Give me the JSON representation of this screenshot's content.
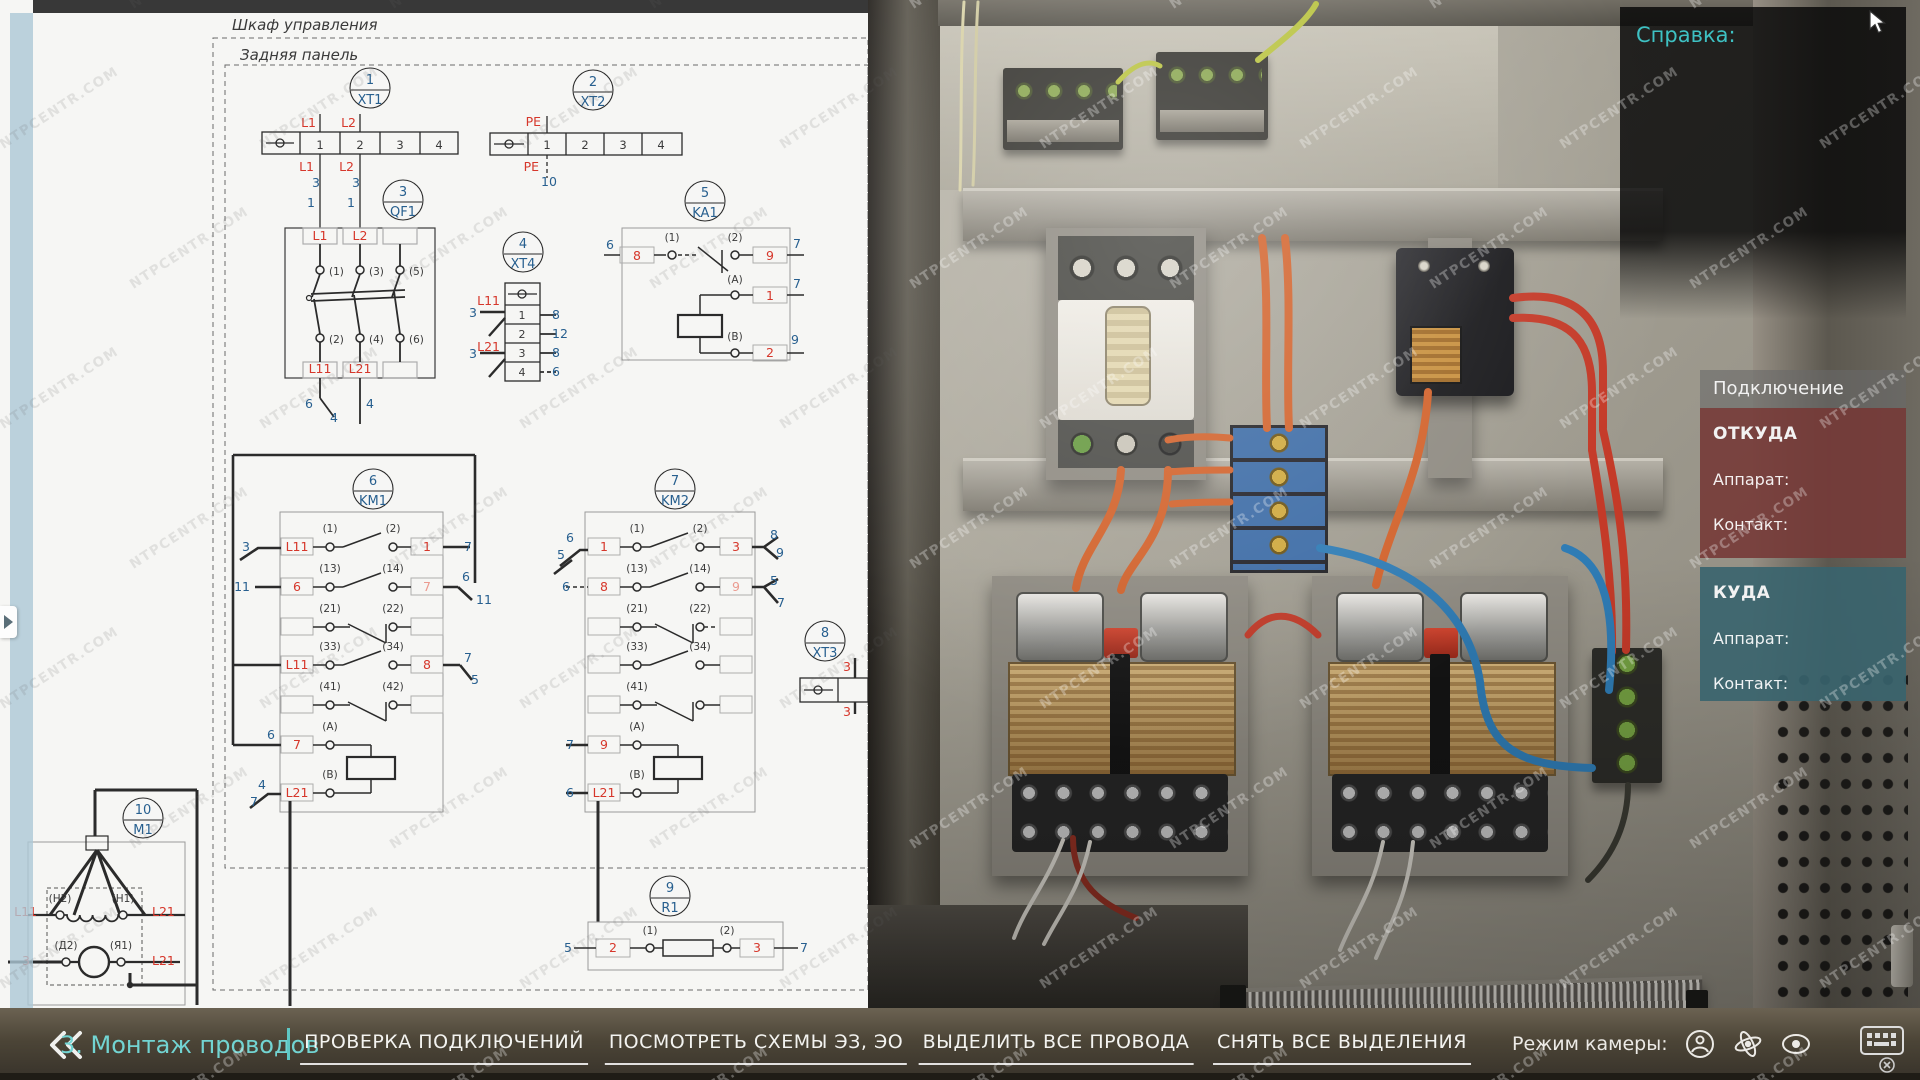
{
  "watermark": {
    "text": "NTPCENTR.COM"
  },
  "help_panel": {
    "title": "Справка:"
  },
  "connection_panel": {
    "title": "Подключение",
    "from": {
      "title": "ОТКУДА",
      "device_label": "Аппарат:",
      "contact_label": "Контакт:"
    },
    "to": {
      "title": "КУДА",
      "device_label": "Аппарат:",
      "contact_label": "Контакт:"
    }
  },
  "toolbar": {
    "step": "3. Монтаж проводов",
    "buttons": [
      "ПРОВЕРКА ПОДКЛЮЧЕНИЙ",
      "ПОСМОТРЕТЬ СХЕМЫ ЭЗ, ЭО",
      "ВЫДЕЛИТЬ ВСЕ ПРОВОДА",
      "СНЯТЬ ВСЕ ВЫДЕЛЕНИЯ"
    ],
    "camera_label": "Режим камеры:"
  },
  "schematic": {
    "colors": {
      "r": "#d6372b",
      "b": "#275f8f",
      "d": "#3a3a3a",
      "p": "#eb9a8f"
    },
    "components": [
      [
        "1",
        "XT1",
        370,
        88
      ],
      [
        "2",
        "XT2",
        593,
        90
      ],
      [
        "3",
        "QF1",
        403,
        200
      ],
      [
        "4",
        "XT4",
        523,
        252
      ],
      [
        "5",
        "KA1",
        705,
        201
      ],
      [
        "6",
        "KM1",
        373,
        489
      ],
      [
        "7",
        "KM2",
        675,
        489
      ],
      [
        "8",
        "XT3",
        825,
        641
      ],
      [
        "9",
        "R1",
        670,
        896
      ],
      [
        "10",
        "M1",
        143,
        818
      ]
    ],
    "labels": [
      [
        "Шкаф управления",
        232,
        30,
        "d",
        "s",
        15,
        1
      ],
      [
        "Задняя панель",
        240,
        60,
        "d",
        "s",
        15,
        1
      ],
      [
        "L1",
        316,
        127,
        "r",
        "e"
      ],
      [
        "L2",
        356,
        127,
        "r",
        "e"
      ],
      [
        "1",
        320,
        149,
        "d",
        "m",
        11.5
      ],
      [
        "2",
        360,
        149,
        "d",
        "m",
        11.5
      ],
      [
        "3",
        400,
        149,
        "d",
        "m",
        11.5
      ],
      [
        "4",
        439,
        149,
        "d",
        "m",
        11.5
      ],
      [
        "L1",
        314,
        171,
        "r",
        "e"
      ],
      [
        "3",
        316,
        187,
        "b",
        "m"
      ],
      [
        "L2",
        354,
        171,
        "r",
        "e"
      ],
      [
        "3",
        356,
        187,
        "b",
        "m"
      ],
      [
        "1",
        315,
        207,
        "b",
        "e"
      ],
      [
        "1",
        355,
        207,
        "b",
        "e"
      ],
      [
        "PE",
        541,
        126,
        "r",
        "e"
      ],
      [
        "1",
        547,
        149,
        "d",
        "m",
        11.5
      ],
      [
        "2",
        585,
        149,
        "d",
        "m",
        11.5
      ],
      [
        "3",
        623,
        149,
        "d",
        "m",
        11.5
      ],
      [
        "4",
        661,
        149,
        "d",
        "m",
        11.5
      ],
      [
        "PE",
        539,
        171,
        "r",
        "e"
      ],
      [
        "10",
        549,
        186,
        "b",
        "m"
      ],
      [
        "L1",
        320,
        240,
        "r",
        "m"
      ],
      [
        "L2",
        360,
        240,
        "r",
        "m"
      ],
      [
        "(1)",
        329,
        275,
        "d",
        "s",
        10.5
      ],
      [
        "(3)",
        369,
        275,
        "d",
        "s",
        10.5
      ],
      [
        "(5)",
        409,
        275,
        "d",
        "s",
        10.5
      ],
      [
        "(2)",
        329,
        343,
        "d",
        "s",
        10.5
      ],
      [
        "(4)",
        369,
        343,
        "d",
        "s",
        10.5
      ],
      [
        "(6)",
        409,
        343,
        "d",
        "s",
        10.5
      ],
      [
        "L11",
        320,
        373,
        "r",
        "m"
      ],
      [
        "L21",
        360,
        373,
        "r",
        "m"
      ],
      [
        "6",
        313,
        408,
        "b",
        "e"
      ],
      [
        "4",
        334,
        422,
        "b",
        "m"
      ],
      [
        "4",
        366,
        408,
        "b",
        "s"
      ],
      [
        "L11",
        500,
        305,
        "r",
        "e"
      ],
      [
        "3",
        477,
        317,
        "b",
        "e"
      ],
      [
        "L21",
        500,
        351,
        "r",
        "e"
      ],
      [
        "3",
        477,
        358,
        "b",
        "e"
      ],
      [
        "1",
        522,
        319,
        "d",
        "m",
        11
      ],
      [
        "2",
        522,
        338,
        "d",
        "m",
        11
      ],
      [
        "3",
        522,
        357,
        "d",
        "m",
        11
      ],
      [
        "4",
        522,
        376,
        "d",
        "m",
        11
      ],
      [
        "8",
        552,
        319,
        "b",
        "s"
      ],
      [
        "12",
        552,
        338,
        "b",
        "s"
      ],
      [
        "8",
        552,
        357,
        "b",
        "s"
      ],
      [
        "6",
        552,
        376,
        "b",
        "s"
      ],
      [
        "6",
        610,
        249,
        "b",
        "m"
      ],
      [
        "8",
        637,
        260,
        "r",
        "m"
      ],
      [
        "(1)",
        672,
        241,
        "d",
        "m",
        10.5
      ],
      [
        "(2)",
        735,
        241,
        "d",
        "m",
        10.5
      ],
      [
        "9",
        770,
        260,
        "r",
        "m"
      ],
      [
        "7",
        793,
        248,
        "b",
        "s"
      ],
      [
        "(A)",
        735,
        283,
        "d",
        "m",
        10.5
      ],
      [
        "1",
        770,
        300,
        "r",
        "m"
      ],
      [
        "7",
        793,
        288,
        "b",
        "s"
      ],
      [
        "(B)",
        735,
        340,
        "d",
        "m",
        10.5
      ],
      [
        "2",
        770,
        357,
        "r",
        "m"
      ],
      [
        "9",
        791,
        344,
        "b",
        "s"
      ],
      [
        "3",
        250,
        551,
        "b",
        "e"
      ],
      [
        "L11",
        297,
        551,
        "r",
        "m"
      ],
      [
        "(1)",
        330,
        532,
        "d",
        "m",
        10.5
      ],
      [
        "(2)",
        393,
        532,
        "d",
        "m",
        10.5
      ],
      [
        "1",
        427,
        551,
        "r",
        "m"
      ],
      [
        "7",
        464,
        551,
        "b",
        "s"
      ],
      [
        "11",
        250,
        591,
        "b",
        "e"
      ],
      [
        "6",
        297,
        591,
        "r",
        "m"
      ],
      [
        "(13)",
        330,
        572,
        "d",
        "m",
        10.5
      ],
      [
        "(14)",
        393,
        572,
        "d",
        "m",
        10.5
      ],
      [
        "7",
        427,
        591,
        "p",
        "m"
      ],
      [
        "6",
        470,
        581,
        "b",
        "e"
      ],
      [
        "11",
        476,
        604,
        "b",
        "s"
      ],
      [
        "(21)",
        330,
        612,
        "d",
        "m",
        10.5
      ],
      [
        "(22)",
        393,
        612,
        "d",
        "m",
        10.5
      ],
      [
        "L11",
        297,
        669,
        "r",
        "m"
      ],
      [
        "(33)",
        330,
        650,
        "d",
        "m",
        10.5
      ],
      [
        "(34)",
        393,
        650,
        "d",
        "m",
        10.5
      ],
      [
        "8",
        427,
        669,
        "r",
        "m"
      ],
      [
        "7",
        464,
        662,
        "b",
        "s"
      ],
      [
        "5",
        471,
        684,
        "b",
        "s"
      ],
      [
        "(41)",
        330,
        690,
        "d",
        "m",
        10.5
      ],
      [
        "(42)",
        393,
        690,
        "d",
        "m",
        10.5
      ],
      [
        "6",
        271,
        739,
        "b",
        "m"
      ],
      [
        "7",
        297,
        749,
        "r",
        "m"
      ],
      [
        "(A)",
        330,
        730,
        "d",
        "m",
        10.5
      ],
      [
        "4",
        266,
        789,
        "b",
        "e"
      ],
      [
        "7",
        258,
        806,
        "b",
        "e"
      ],
      [
        "L21",
        297,
        797,
        "r",
        "m"
      ],
      [
        "(B)",
        330,
        778,
        "d",
        "m",
        10.5
      ],
      [
        "6",
        574,
        542,
        "b",
        "e"
      ],
      [
        "5",
        565,
        559,
        "b",
        "e"
      ],
      [
        "1",
        604,
        551,
        "r",
        "m"
      ],
      [
        "(1)",
        637,
        532,
        "d",
        "m",
        10.5
      ],
      [
        "(2)",
        700,
        532,
        "d",
        "m",
        10.5
      ],
      [
        "3",
        736,
        551,
        "r",
        "m"
      ],
      [
        "8",
        770,
        539,
        "b",
        "s"
      ],
      [
        "9",
        776,
        557,
        "b",
        "s"
      ],
      [
        "6",
        570,
        591,
        "b",
        "e"
      ],
      [
        "8",
        604,
        591,
        "r",
        "m"
      ],
      [
        "(13)",
        637,
        572,
        "d",
        "m",
        10.5
      ],
      [
        "(14)",
        700,
        572,
        "d",
        "m",
        10.5
      ],
      [
        "9",
        736,
        591,
        "p",
        "m"
      ],
      [
        "5",
        770,
        585,
        "b",
        "s"
      ],
      [
        "7",
        777,
        607,
        "b",
        "s"
      ],
      [
        "(21)",
        637,
        612,
        "d",
        "m",
        10.5
      ],
      [
        "(22)",
        700,
        612,
        "d",
        "m",
        10.5
      ],
      [
        "(33)",
        637,
        650,
        "d",
        "m",
        10.5
      ],
      [
        "(34)",
        700,
        650,
        "d",
        "m",
        10.5
      ],
      [
        "(41)",
        637,
        690,
        "d",
        "m",
        10.5
      ],
      [
        "7",
        574,
        749,
        "b",
        "e"
      ],
      [
        "9",
        604,
        749,
        "r",
        "m"
      ],
      [
        "(A)",
        637,
        730,
        "d",
        "m",
        10.5
      ],
      [
        "6",
        574,
        797,
        "b",
        "e"
      ],
      [
        "L21",
        604,
        797,
        "r",
        "m"
      ],
      [
        "(B)",
        637,
        778,
        "d",
        "m",
        10.5
      ],
      [
        "3",
        847,
        671,
        "r",
        "m"
      ],
      [
        "3",
        847,
        716,
        "r",
        "m"
      ],
      [
        "5",
        572,
        952,
        "b",
        "e"
      ],
      [
        "2",
        613,
        952,
        "r",
        "m"
      ],
      [
        "(1)",
        650,
        934,
        "d",
        "m",
        10.5
      ],
      [
        "(2)",
        727,
        934,
        "d",
        "m",
        10.5
      ],
      [
        "3",
        757,
        952,
        "r",
        "m"
      ],
      [
        "7",
        800,
        952,
        "b",
        "s"
      ],
      [
        "(Н2)",
        60,
        902,
        "d",
        "m",
        10.5
      ],
      [
        "(Н1)",
        123,
        902,
        "d",
        "m",
        10.5
      ],
      [
        "L11",
        37,
        916,
        "r",
        "e"
      ],
      [
        "L21",
        152,
        916,
        "r",
        "s"
      ],
      [
        "(Д2)",
        66,
        949,
        "d",
        "m",
        10.5
      ],
      [
        "(Я1)",
        121,
        949,
        "d",
        "m",
        10.5
      ],
      [
        "3",
        26,
        965,
        "r",
        "m"
      ],
      [
        "L21",
        152,
        965,
        "r",
        "s"
      ]
    ]
  }
}
